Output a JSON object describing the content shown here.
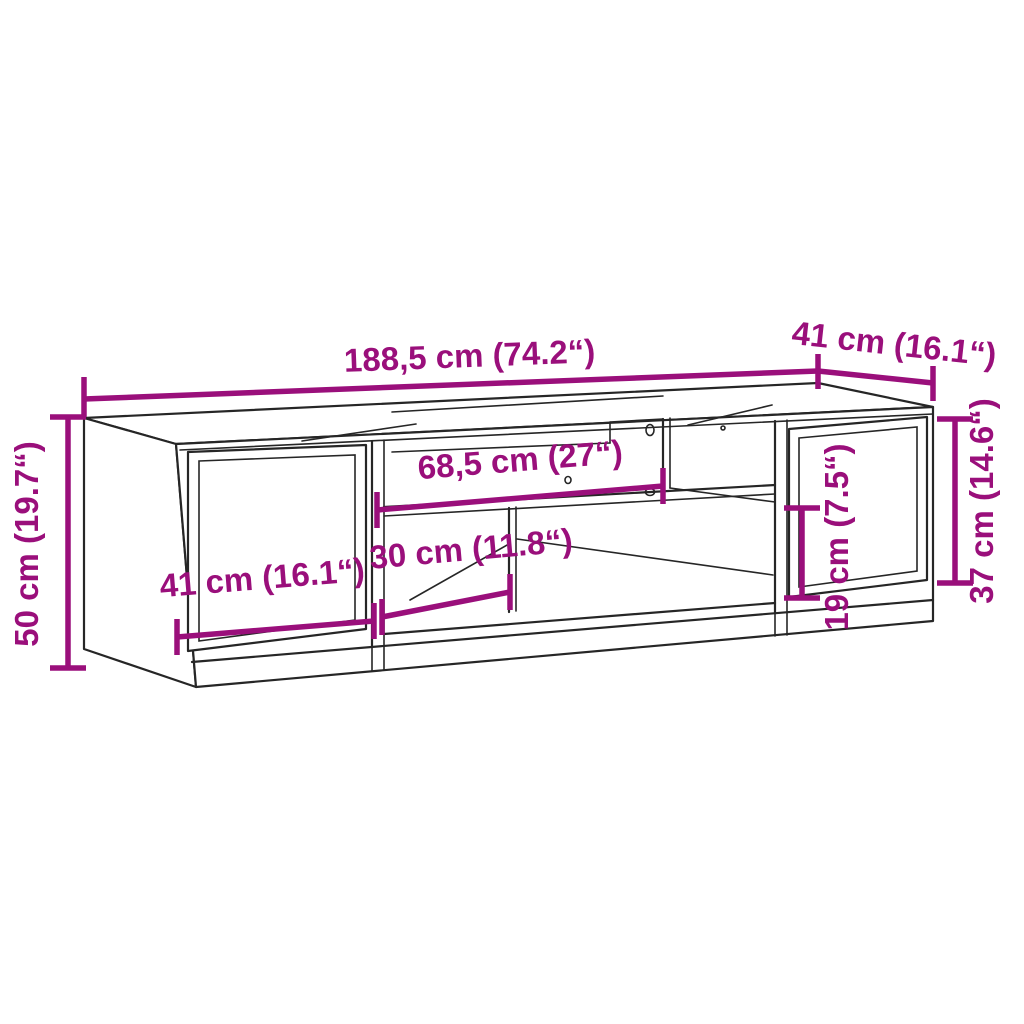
{
  "diagram": {
    "subject": "tv-stand-dimension-diagram",
    "colors": {
      "background": "#ffffff",
      "outline": "#262626",
      "dimension_accent": "#9a0f7b"
    },
    "dimensions": {
      "overall_width": "188,5 cm (74.2“)",
      "overall_depth": "41 cm (16.1“)",
      "overall_height": "50 cm (19.7“)",
      "right_section_height": "37 cm (14.6“)",
      "top_compartment_width": "68,5 cm (27“)",
      "left_door_width": "41 cm (16.1“)",
      "lower_compartment_width": "30 cm (11.8“)",
      "side_compartment_height": "19 cm (7.5“)"
    }
  }
}
